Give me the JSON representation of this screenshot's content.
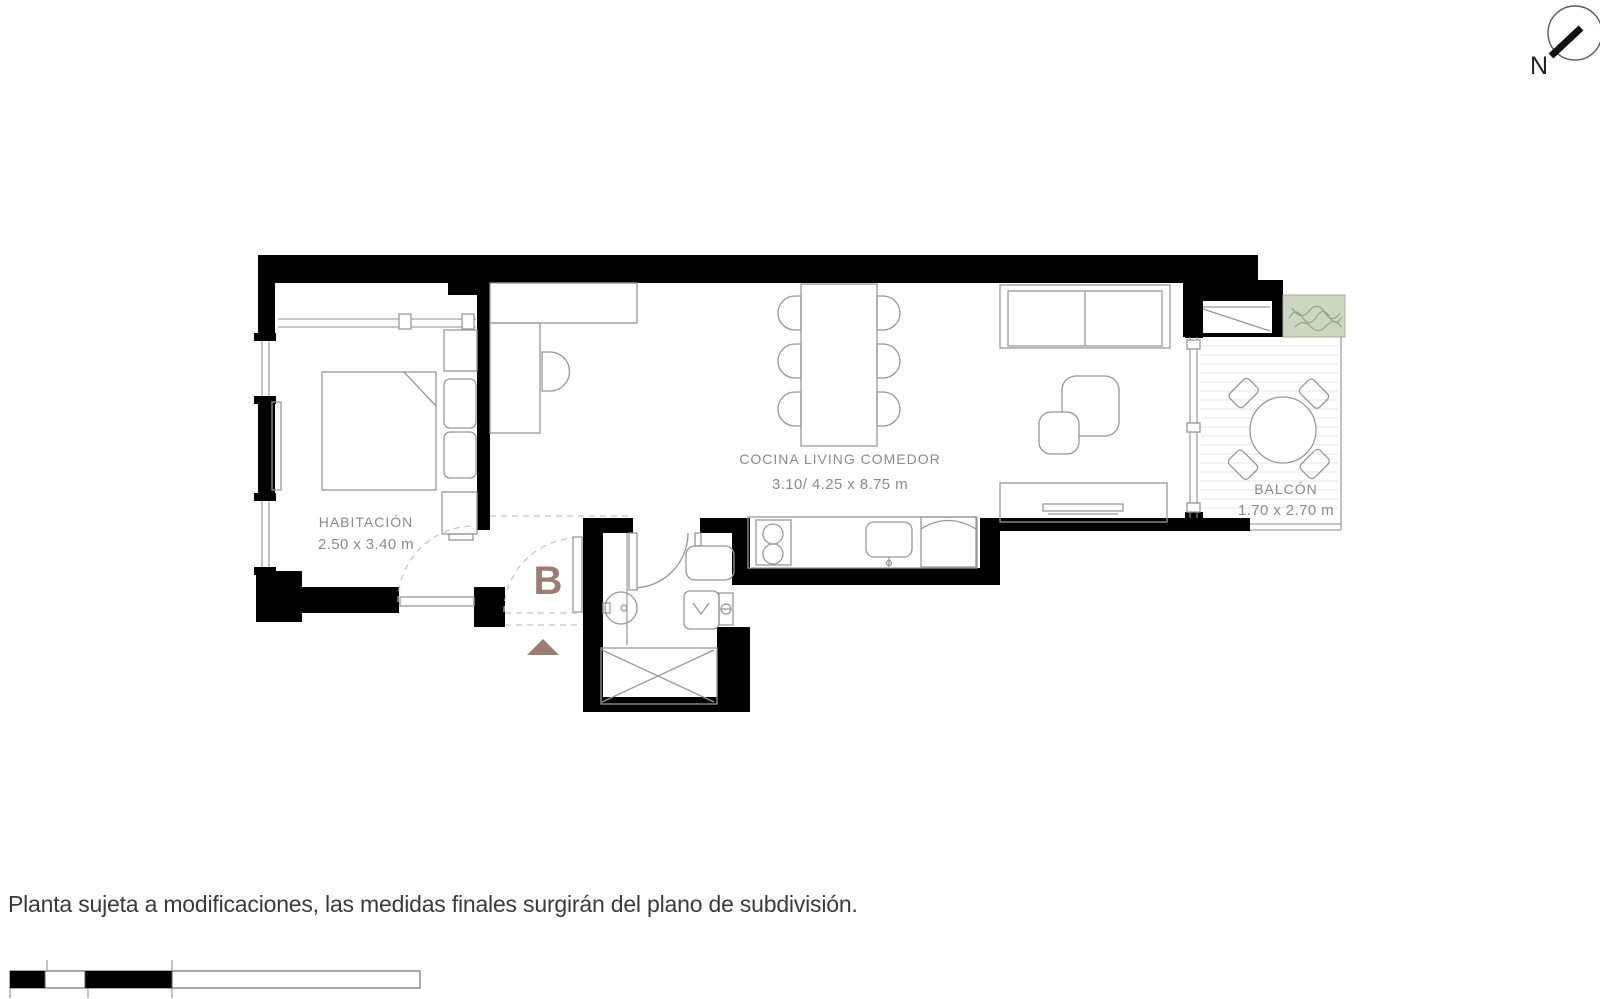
{
  "page": {
    "disclaimer": "Planta sujeta a modificaciones, las medidas finales surgirán del plano de subdivisión."
  },
  "compass": {
    "north_label": "N"
  },
  "unit_label": "B",
  "rooms": {
    "bedroom": {
      "name": "HABITACIÓN",
      "dimensions": "2.50 x 3.40 m"
    },
    "kitchen_living": {
      "name": "COCINA LIVING COMEDOR",
      "dimensions": "3.10/ 4.25 x 8.75 m"
    },
    "balcony": {
      "name": "BALCÓN",
      "dimensions": "1.70 x 2.70 m"
    }
  },
  "colors": {
    "wall": "#000000",
    "accent": "#9c7b73",
    "planter_fill": "#ccd6c0",
    "furniture_line": "#979797",
    "label_text": "#8a8a8a",
    "caption_text": "#3a3a3a"
  }
}
